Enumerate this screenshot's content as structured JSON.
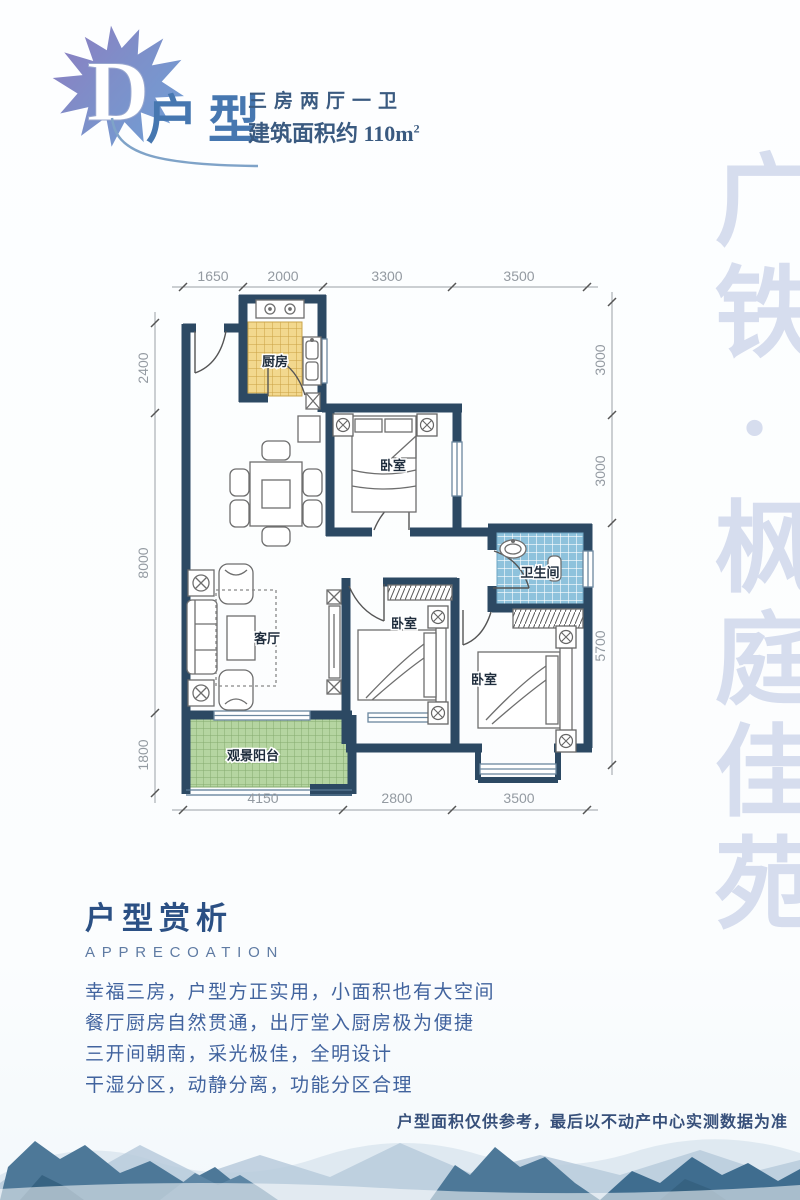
{
  "header": {
    "badge_letter": "D",
    "title": "户型",
    "layout_line": "三房两厅一卫",
    "area_line": "建筑面积约 110m",
    "area_sup": "2"
  },
  "watermark": "广铁·枫庭佳苑",
  "floorplan": {
    "rooms": {
      "kitchen": "厨房",
      "bedroom_top": "卧室",
      "bedroom_middle": "卧室",
      "bedroom_right": "卧室",
      "bathroom": "卫生间",
      "living": "客厅",
      "balcony": "观景阳台"
    },
    "dims": {
      "top": [
        "1650",
        "2000",
        "3300",
        "3500"
      ],
      "bottom": [
        "4150",
        "2800",
        "3500"
      ],
      "left": [
        "2400",
        "8000",
        "1800"
      ],
      "right": [
        "3000",
        "3000",
        "5700"
      ]
    }
  },
  "appreciation": {
    "title": "户型赏析",
    "subtitle": "APPRECOATION",
    "lines": [
      "幸福三房，户型方正实用，小面积也有大空间",
      "餐厅厨房自然贯通，出厅堂入厨房极为便捷",
      "三开间朝南，采光极佳，全明设计",
      "干湿分区，动静分离，功能分区合理"
    ]
  },
  "disclaimer": "户型面积仅供参考，最后以不动产中心实测数据为准",
  "colors": {
    "wall": "#2c4963",
    "kitchen_tile": "#f2d88e",
    "bath_tile": "#8ec2dc",
    "balcony_tile": "#b5d5a1",
    "accent_blue": "#4677b0",
    "watermark_blue": "#d6ddee"
  }
}
